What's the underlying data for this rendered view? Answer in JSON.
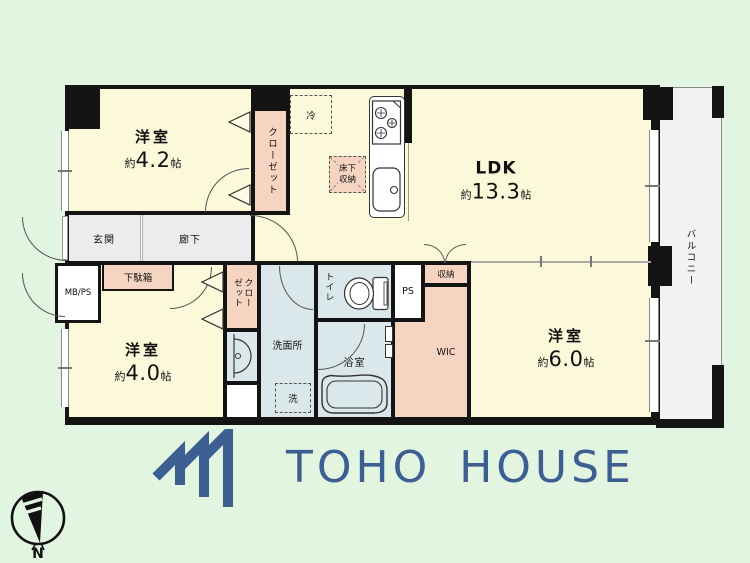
{
  "plan": {
    "rooms": {
      "bedroom1": {
        "name": "洋室",
        "size_about": "約",
        "size_value": "4.2",
        "size_unit": "帖"
      },
      "bedroom2": {
        "name": "洋室",
        "size_about": "約",
        "size_value": "4.0",
        "size_unit": "帖"
      },
      "bedroom3": {
        "name": "洋室",
        "size_about": "約",
        "size_value": "6.0",
        "size_unit": "帖"
      },
      "ldk": {
        "name": "LDK",
        "size_about": "約",
        "size_value": "13.3",
        "size_unit": "帖"
      }
    },
    "labels": {
      "entrance": "玄関",
      "hallway": "廊下",
      "shoe_cabinet": "下駄箱",
      "meter_pipe_space": "MB/PS",
      "closet": "クローゼット",
      "washroom": "洗面所",
      "toilet": "トイレ",
      "bathroom": "浴室",
      "washer": "洗",
      "walk_in_closet": "WIC",
      "pipe_space": "PS",
      "storage": "収納",
      "refrigerator": "冷",
      "underfloor_storage": "床下収納",
      "balcony": "バルコニー"
    },
    "compass_north": "N"
  },
  "branding": {
    "company_name": "TOHO HOUSE"
  },
  "colors": {
    "background": "#e2f5e1",
    "room_floor": "#fbf9da",
    "closet_fill": "#f5d5c2",
    "hall_floor": "#ececec",
    "wet_area": "#dbe8eb",
    "balcony_floor": "#f2f2f1",
    "wall": "#141414",
    "brand_blue": "#3d5e91"
  }
}
